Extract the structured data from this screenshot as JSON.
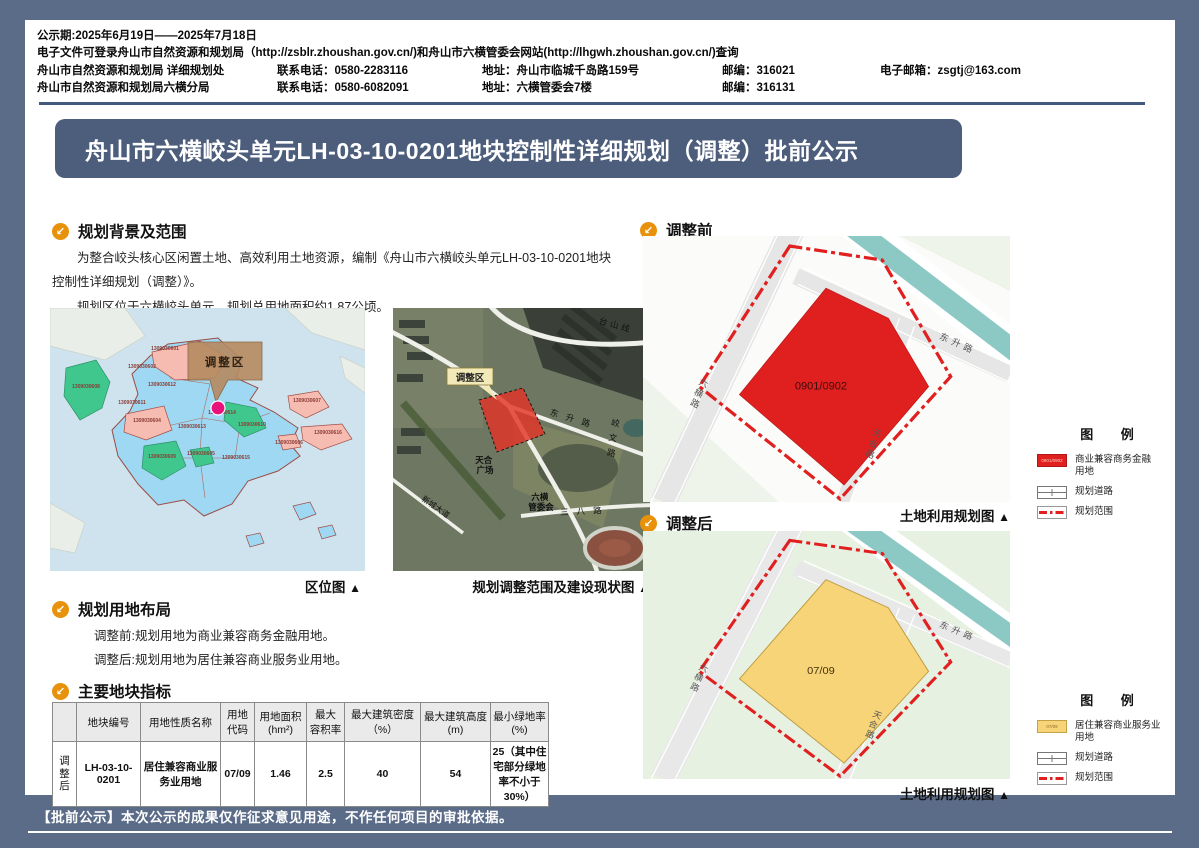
{
  "colors": {
    "frame": "#5b6c88",
    "accent": "#4d5e7c",
    "icon_orange": "#e8920c",
    "parcel_before": "#e01f1f",
    "parcel_after": "#f8d478",
    "boundary_red": "#e01f1f"
  },
  "header": {
    "line1": "公示期:2025年6月19日——2025年7月18日",
    "line2": "电子文件可登录舟山市自然资源和规划局（http://zsblr.zhoushan.gov.cn/)和舟山市六横管委会网站(http://lhgwh.zhoushan.gov.cn/)查询",
    "row1": {
      "dept": "舟山市自然资源和规划局 详细规划处",
      "phone": "联系电话：0580-2283116",
      "addr": "地址：舟山市临城千岛路159号",
      "zip": "邮编：316021",
      "email": "电子邮箱：zsgtj@163.com"
    },
    "row2": {
      "dept": "舟山市自然资源和规划局六横分局",
      "phone": "联系电话：0580-6082091",
      "addr": "地址：六横管委会7楼",
      "zip": "邮编：316131"
    }
  },
  "title": "舟山市六横峧头单元LH-03-10-0201地块控制性详细规划（调整）批前公示",
  "sections": {
    "background": {
      "heading": "规划背景及范围",
      "para1": "为整合峧头核心区闲置土地、高效利用土地资源，编制《舟山市六横峧头单元LH-03-10-0201地块控制性详细规划（调整）》。",
      "para2": "规划区位于六横峧头单元，规划总用地面积约1.87公顷。"
    },
    "layout": {
      "heading": "规划用地布局",
      "line1": "调整前:规划用地为商业兼容商务金融用地。",
      "line2": "调整后:规划用地为居住兼容商业服务业用地。"
    },
    "indicators": {
      "heading": "主要地块指标"
    }
  },
  "captions": {
    "left_map": "区位图",
    "sat_map": "规划调整范围及建设现状图",
    "land_use": "土地利用规划图",
    "tri": "▲"
  },
  "table": {
    "headers": [
      "",
      "地块编号",
      "用地性质名称",
      "用地\n代码",
      "用地面积\n(hm²)",
      "最大\n容积率",
      "最大建筑密度（%）",
      "最大建筑高度\n(m)",
      "最小绿地率\n(%)"
    ],
    "row_label": "调\n整\n后",
    "cells": [
      "LH-03-10-0201",
      "居住兼容商业服务业用地",
      "07/09",
      "1.46",
      "2.5",
      "40",
      "54",
      "25（其中住宅部分绿地率不小于30%）"
    ]
  },
  "maps": {
    "before_heading": "调整前",
    "after_heading": "调整后",
    "before_parcel_label": "0901/0902",
    "after_parcel_label": "07/09",
    "roads": {
      "dongsheng": "东升路",
      "liuheng": "六横路",
      "tianhe": "天合路"
    }
  },
  "locmap": {
    "callout": "调整区",
    "units": [
      "1309030601",
      "1309030602",
      "1309030612",
      "1309030611",
      "1309030608",
      "1309030604",
      "1309030613",
      "1309030614",
      "1309030610",
      "1309030607",
      "1309030616",
      "1309030606",
      "1309030609",
      "1309030605",
      "1309030615"
    ]
  },
  "satmap": {
    "callout": "调整区",
    "labels": [
      "台山线",
      "东升路",
      "峧文路",
      "三八路",
      "新城大道"
    ],
    "tianhe": [
      "天合",
      "广场"
    ],
    "lh": [
      "六横",
      "管委会"
    ]
  },
  "legend": {
    "title": "图 例",
    "before_use": "商业兼容商务金融\n用地",
    "after_use": "居住兼容商业服务业\n用地",
    "road": "规划道路",
    "range": "规划范围",
    "before_swatch_text": "0901/0902",
    "after_swatch_text": "07/09"
  },
  "footer": "【批前公示】本次公示的成果仅作征求意见用途，不作任何项目的审批依据。"
}
